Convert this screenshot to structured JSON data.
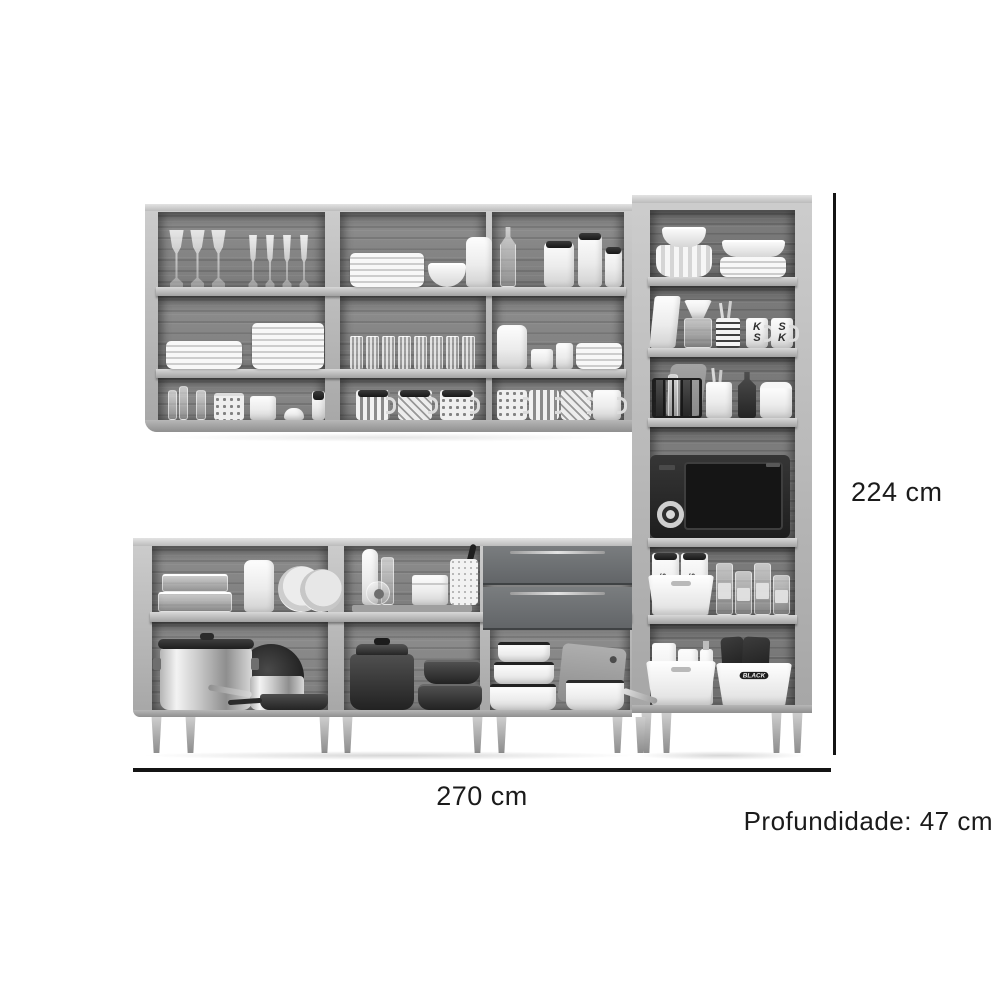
{
  "image": {
    "background": "#ffffff",
    "kind": "product-dimension-diagram",
    "subject": "modular kitchen cabinet set (grayscale) filled with dishware, cookware, pantry items and a microwave"
  },
  "dimensions": {
    "height": "224 cm",
    "width": "270 cm",
    "depth": "Profundidade: 47 cm"
  },
  "annotation_style": {
    "line_color": "#141414",
    "text_color": "#1b1b1b"
  },
  "item_text": {
    "letter_mugs": [
      "KS",
      "SK"
    ],
    "pasta_pack": "PAS",
    "salt_packet": "SEA SALT",
    "bin_label": "BLACK"
  },
  "palette": {
    "cabinet_frame": "#b5b5b5",
    "cabinet_interior_wood": "#868686",
    "drawer_front": "#6d7072",
    "microwave_body": "#262626",
    "dishware_white": "#f2f2f2"
  }
}
